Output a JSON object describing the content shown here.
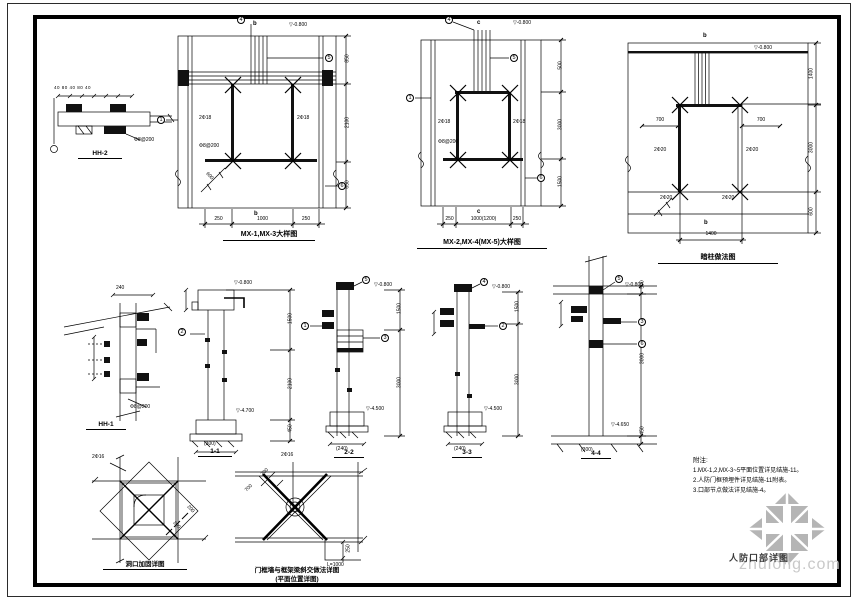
{
  "sheet": {
    "name": "人防口部详图",
    "watermark": "zhulong.com",
    "paper_color": "#ffffff",
    "line_color": "#000000",
    "watermark_gray": "#b5b5b5"
  },
  "details": {
    "hh2": {
      "caption": "HH-2",
      "dims_top": "40 80 40 80 40",
      "rebar_label": "Φ8@200"
    },
    "mx13": {
      "caption": "MX-1,MX-3大样图",
      "axis_top": "b",
      "axis_bottom": "b",
      "elev_top": "▽-0.800",
      "rebar_left": "2Φ18",
      "rebar_right": "2Φ18",
      "stirrup": "Φ8@200",
      "diag_dim": "600",
      "dims_bottom": [
        "250",
        "1000",
        "250"
      ],
      "dims_right": [
        "850",
        "2100",
        "650"
      ],
      "refs": {
        "r1": "1",
        "r4": "4",
        "r5": "5",
        "r6": "6"
      }
    },
    "mx245": {
      "caption": "MX-2,MX-4(MX-5)大样图",
      "axis_top": "c",
      "axis_bottom": "c",
      "elev_top": "▽-0.800",
      "rebar_left": "2Φ18",
      "rebar_right": "2Φ18",
      "stirrup": "Φ8@200",
      "dims_bottom": [
        "250",
        "1000(1200)",
        "250"
      ],
      "dims_right": [
        "500",
        "3000",
        "1500"
      ],
      "refs": {
        "r1": "1",
        "r4": "4",
        "r5": "5",
        "r6": "6"
      }
    },
    "anzhu": {
      "caption": "暗柱做法图",
      "axis_top": "b",
      "axis_bottom": "b",
      "elev_top": "▽-0.800",
      "dim_left": "700",
      "dim_right": "700",
      "rebar_left": "2Φ20",
      "rebar_right": "2Φ20",
      "rebar_bottom_left": "2Φ20",
      "rebar_bottom_right": "2Φ20",
      "dim_bottom": "1400",
      "dims_right": [
        "1400",
        "3000",
        "600"
      ]
    },
    "hh1": {
      "caption": "HH-1",
      "dim_top": "240",
      "rebar_label": "Φ8@200"
    },
    "s11": {
      "caption": "1-1",
      "elev_top": "▽-0.800",
      "elev_bottom": "▽-4.700",
      "dim_bottom": "(300)",
      "dims_right": [
        "1500",
        "2100",
        "450"
      ],
      "refs": {
        "r2": "2"
      }
    },
    "s22": {
      "caption": "2-2",
      "elev_top": "▽-0.800",
      "elev_bottom": "▽-4.500",
      "dim_bottom": "(240)",
      "dims_right": [
        "1500",
        "3000"
      ],
      "refs": {
        "r1": "1",
        "r3": "3",
        "r5": "5"
      }
    },
    "s33": {
      "caption": "3-3",
      "elev_top": "▽-0.800",
      "elev_bottom": "▽-4.500",
      "dim_bottom": "(240)",
      "dims_right": [
        "1500",
        "3000"
      ],
      "refs": {
        "r2": "2",
        "r4": "4"
      }
    },
    "s44": {
      "caption": "4-4",
      "elev_top": "▽-0.800",
      "elev_bottom": "▽-4.650",
      "dim_bottom": "(300)",
      "dims_right": [
        "500",
        "3000",
        "450"
      ],
      "refs": {
        "r3": "3",
        "r5": "5",
        "r6": "6"
      }
    },
    "plan1": {
      "caption": "洞口加固详图",
      "rebar_label": "2Φ16",
      "dim_a": "200",
      "dim_b": "200"
    },
    "plan2": {
      "caption_line1": "门框墙与框架梁斜交做法详图",
      "caption_line2": "(平面位置详图)",
      "top_label": "2Φ16",
      "dim_a": "700",
      "dim_b": "700",
      "side_dim": "250",
      "plate_label": "L=1000"
    }
  },
  "notes": {
    "title": "附注:",
    "items": [
      "1.MX-1,2,MX-3~5平面位置详见结施-11。",
      "2.人防门框预埋件详见结施-11附表。",
      "3.口部节点做法详见结施-4。"
    ]
  }
}
